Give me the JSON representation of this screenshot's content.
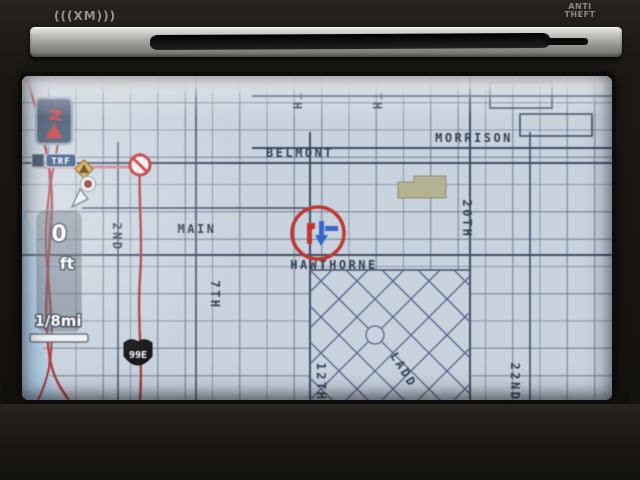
{
  "device": {
    "xm_label": "(((XM)))",
    "anti_theft_1": "ANTI",
    "anti_theft_2": "THEFT"
  },
  "hud": {
    "compass_n": "N",
    "traffic_badge": "TRF",
    "distance_value": "0",
    "distance_unit": "ft",
    "scale_label": "1/8mi",
    "highway_shield": "99E"
  },
  "map": {
    "streets": {
      "belmont": "BELMONT",
      "morrison": "MORRISON",
      "main": "MAIN",
      "hawthorne": "HAWTHORNE",
      "second": "2ND",
      "seventh": "7TH",
      "twelfth": "12TH",
      "twentieth": "20TH",
      "twentysecond": "22ND",
      "ladd": "LADD",
      "partial_top_left": "TH",
      "partial_top_right": "TH"
    },
    "colors": {
      "background": "#c9d3de",
      "river": "#b2cfe6",
      "grid_line": "#50607a",
      "major_road": "#3e4c68",
      "route_red": "#a93a3c",
      "label": "#333f52",
      "label_maroon": "#6e2b3d",
      "park_block": "#b3b394",
      "marker_red": "#bf3631",
      "marker_blue": "#3a66c9"
    }
  }
}
